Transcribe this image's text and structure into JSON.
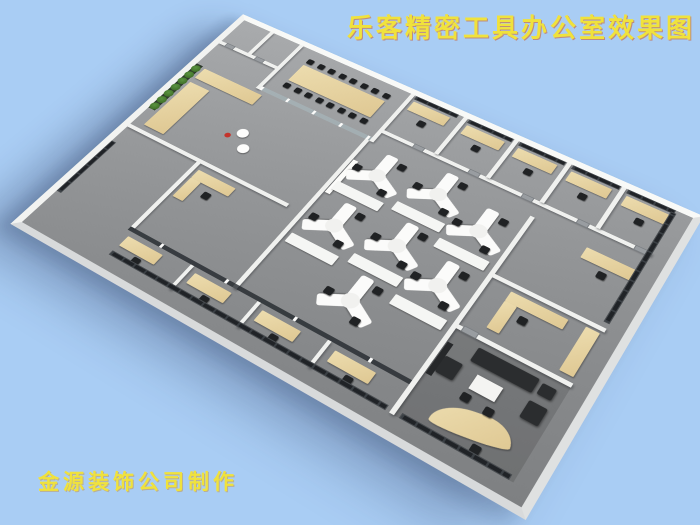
{
  "title": "乐客精密工具办公室效果图",
  "credit": "金源装饰公司制作",
  "palette": {
    "background": "#a9cdf4",
    "caption_yellow": "#f0e23c",
    "floor_gray": "#8f9193",
    "wall_white": "#f0f1ef",
    "wood": "#e6d2a0",
    "window_dark": "#26282b",
    "chair_black": "#202224",
    "plant_green": "#3e6b2e",
    "sofa_black": "#2b2d2f",
    "accent_red": "#c4342c"
  }
}
